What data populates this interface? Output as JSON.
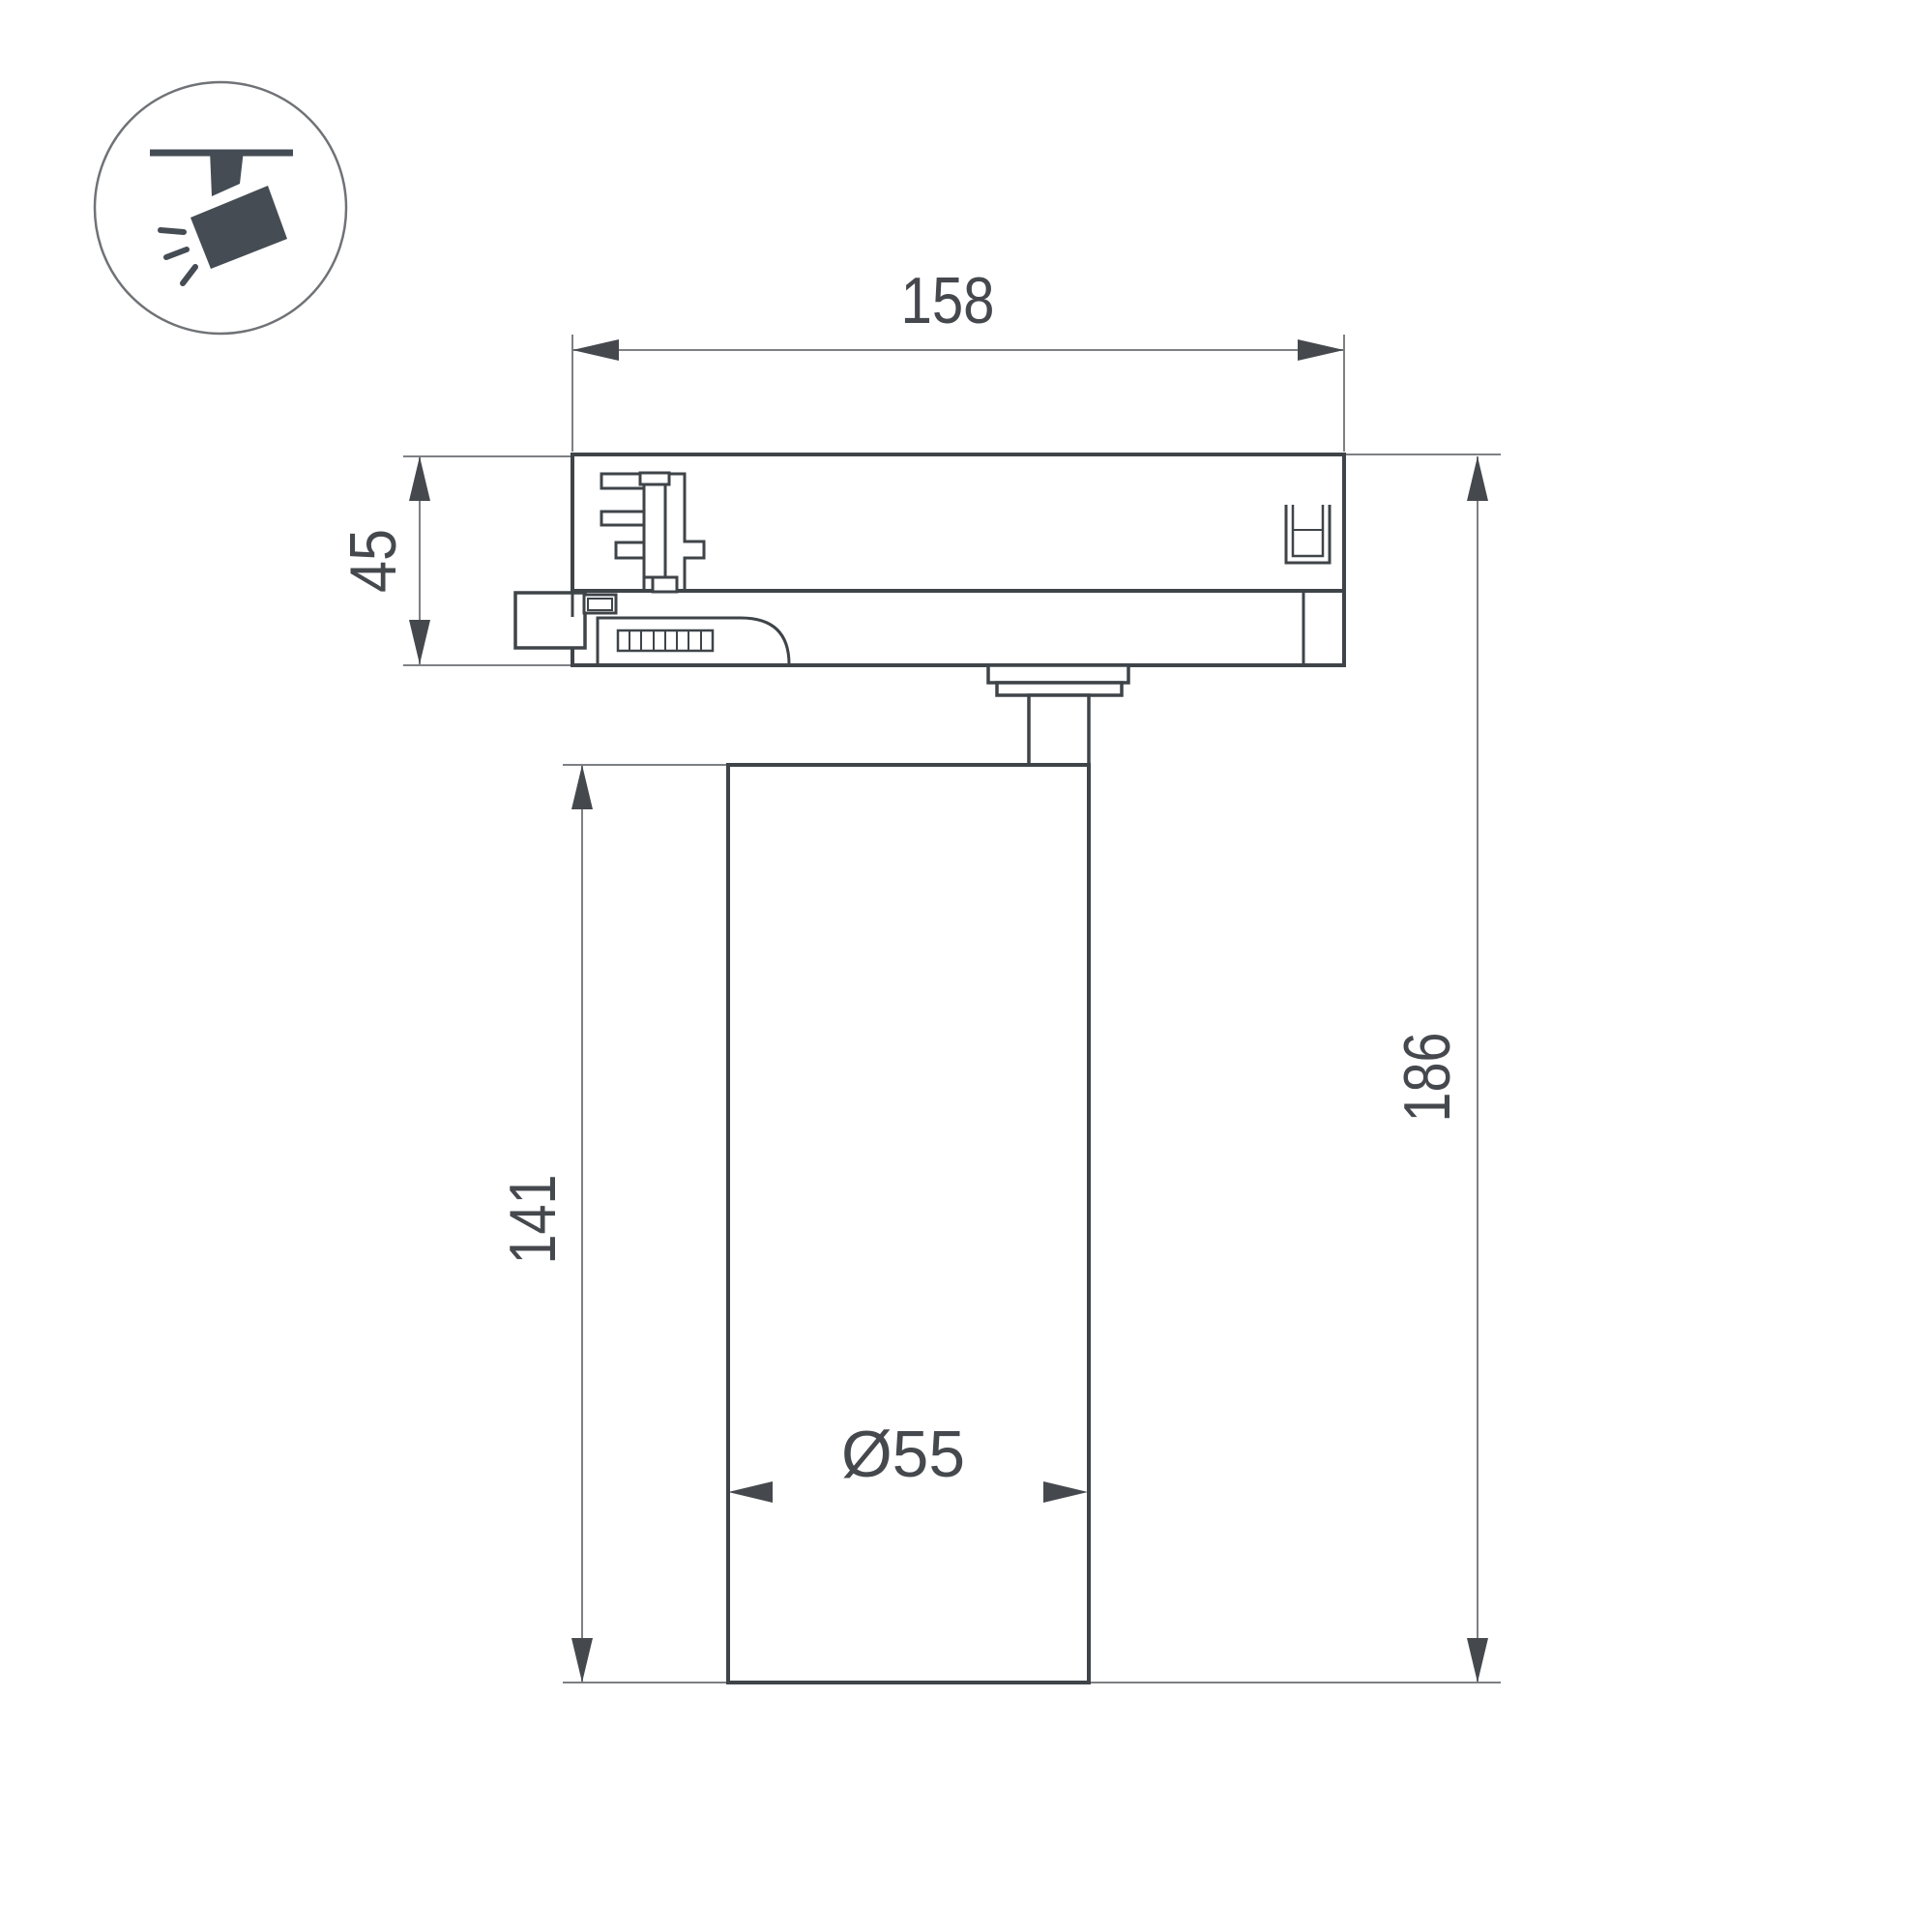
{
  "drawing": {
    "title": "track-spotlight-dimension-drawing",
    "icon": {
      "name": "track-spotlight-icon"
    },
    "dimensions": {
      "total_width": "158",
      "adapter_height": "45",
      "body_height": "141",
      "total_height": "186",
      "body_diameter": "Ø55"
    },
    "colors": {
      "background": "#ffffff",
      "object_line": "#3f4449",
      "dimension_line": "#7d8084",
      "dimension_text": "#45494e",
      "icon_fill": "#454c54"
    }
  }
}
